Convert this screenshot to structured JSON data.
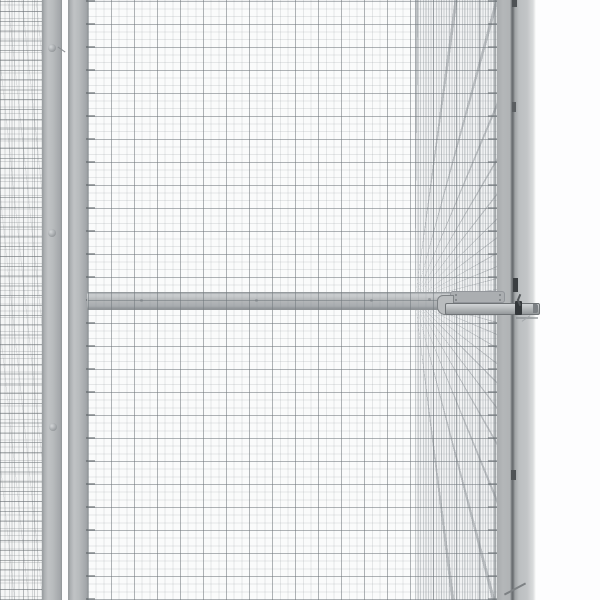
{
  "meta": {
    "title": "Wire mesh enclosure close-up",
    "description": "Close-up product photograph of a grey galvanised steel wire-mesh pet enclosure: fine square mesh panels, two vertical frame posts on the left with round bolt heads, a horizontal middle rail with a slide-bolt latch, a dense side-mesh panel receding in perspective, and a front-right corner post against a white studio background.",
    "visible_text": ""
  },
  "palette": {
    "page_bg": "#fdfdfe",
    "panel_bg": "#fafbfb",
    "frame_gray": "#b4b8ba",
    "frame_edge": "#8e9295",
    "seam_dark": "#6b6f72",
    "latch_dark": "#33373a",
    "mesh_dark_line": "rgba(108,115,120,0.45)",
    "mesh_fine_line": "rgba(140,147,152,0.20)",
    "dense_vertical_line": "rgba(160,166,170,0.5)",
    "fan_line": "rgba(128,134,139,0.45)",
    "left_h_line": "rgba(100,106,110,0.5)",
    "left_v_line": "rgba(140,146,150,0.32)"
  },
  "scene": {
    "parts": [
      {
        "id": "left-side-mesh-panel",
        "label": "Left side wire-mesh panel seen at an angle"
      },
      {
        "id": "left-frame-post",
        "label": "Left frame post with round bolt heads"
      },
      {
        "id": "front-left-post",
        "label": "Front-left frame post with welded wire ends"
      },
      {
        "id": "front-mesh-panel",
        "label": "Front square wire-mesh panel"
      },
      {
        "id": "mid-rail",
        "label": "Horizontal middle frame rail"
      },
      {
        "id": "door-post",
        "label": "Door-side vertical frame member"
      },
      {
        "id": "side-mesh-perspective",
        "label": "Dense side mesh receding toward the corner"
      },
      {
        "id": "corner-post",
        "label": "Front-right corner post with dark seam"
      },
      {
        "id": "latch",
        "label": "Slide-bolt door latch on the middle rail"
      },
      {
        "id": "background",
        "label": "White studio background"
      }
    ]
  }
}
